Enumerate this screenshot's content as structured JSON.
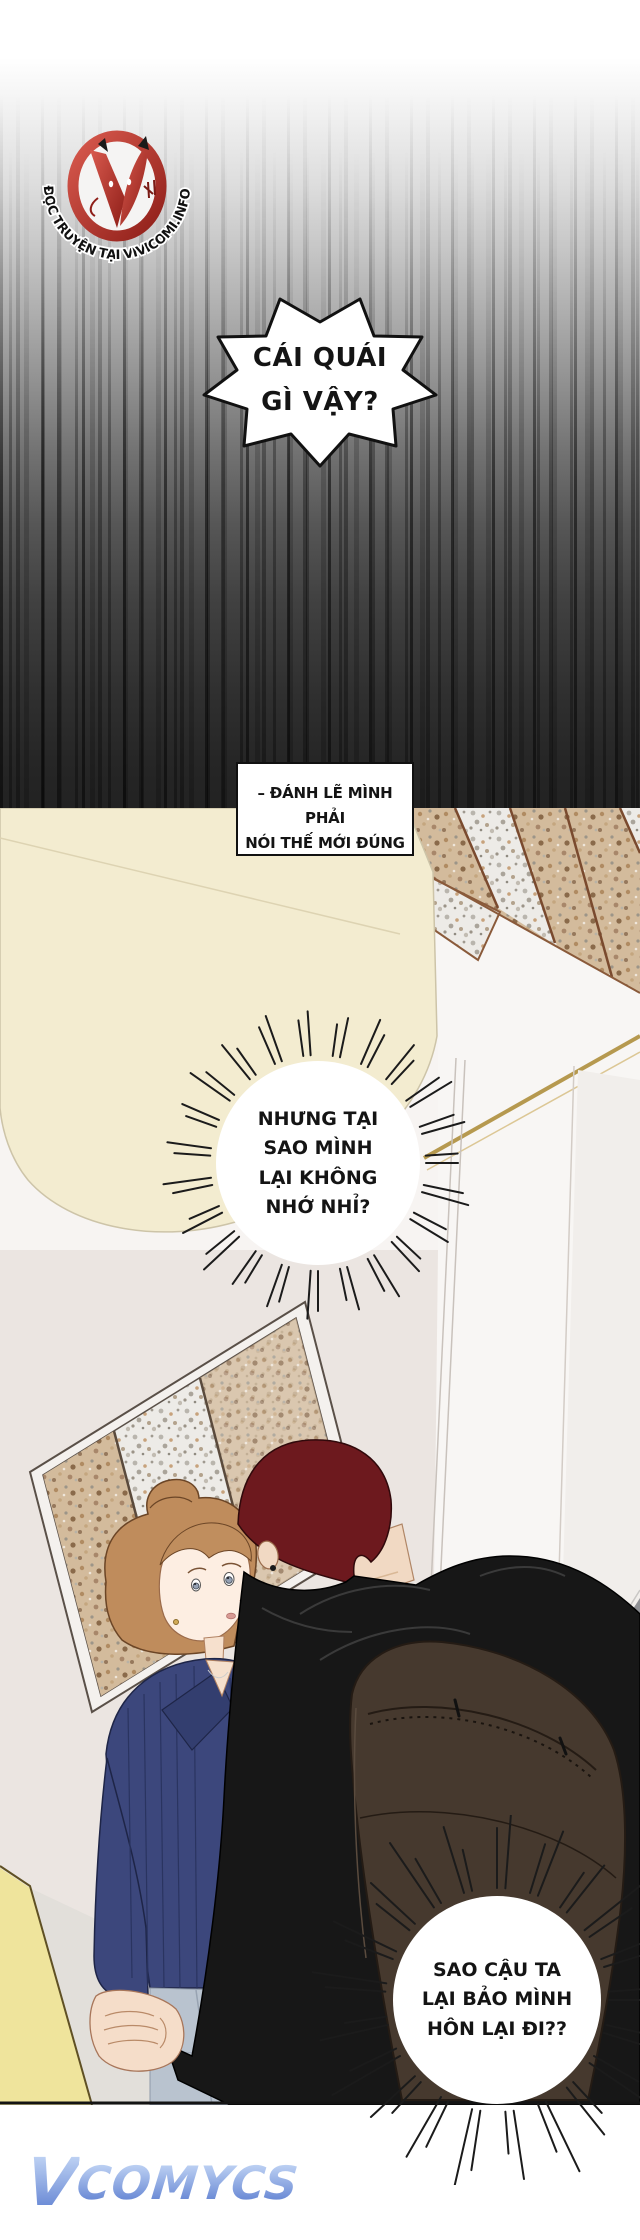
{
  "page": {
    "width": 640,
    "height": 2240,
    "background": "#ffffff"
  },
  "header": {
    "credit_label": "그림",
    "credit_artist": "해숲"
  },
  "logo": {
    "curved_text": "ĐỌC TRUYỆN TẠI VIVICOMI.INFO",
    "ring_color": "#b3271e"
  },
  "bubbles": {
    "shout": {
      "shape": "spiky",
      "lines": [
        "CÁI QUÁI",
        "GÌ VẬY?"
      ]
    },
    "caption": {
      "shape": "box",
      "lines": [
        "– ĐÁNH LẼ MÌNH PHẢI",
        "NÓI THẾ MỚI ĐÚNG"
      ]
    },
    "thought1": {
      "shape": "burst",
      "lines": [
        "NHƯNG TẠI",
        "SAO MÌNH",
        "LẠI KHÔNG",
        "NHỚ NHỈ?"
      ]
    },
    "thought2": {
      "shape": "burst",
      "lines": [
        "SAO CẬU TA",
        "LẠI BẢO MÌNH",
        "HÔN LẠI ĐI??"
      ]
    }
  },
  "scene": {
    "wall_cream": "#f3ecd0",
    "wall_light": "#f7f4f2",
    "wall_mirror": "#ebe5e1",
    "tile_tan": "#d3bb9c",
    "tile_white": "#edebe7",
    "grout": "#7a4a2e",
    "gold_trim": "#b6994f",
    "baseboard": "#8f9094",
    "floor": "#f6f7f8",
    "accent_yellow": "#efe49c",
    "skin": "#f5ddc9",
    "woman_hair": "#bf8c5c",
    "woman_sweater": "#3c477c",
    "woman_jeans": "#b9c3cf",
    "man_hair": "#6d191e",
    "man_hoodie": "#171717",
    "backpack": "#46392e"
  },
  "watermark": {
    "initial": "V",
    "rest": "COMYCS"
  }
}
